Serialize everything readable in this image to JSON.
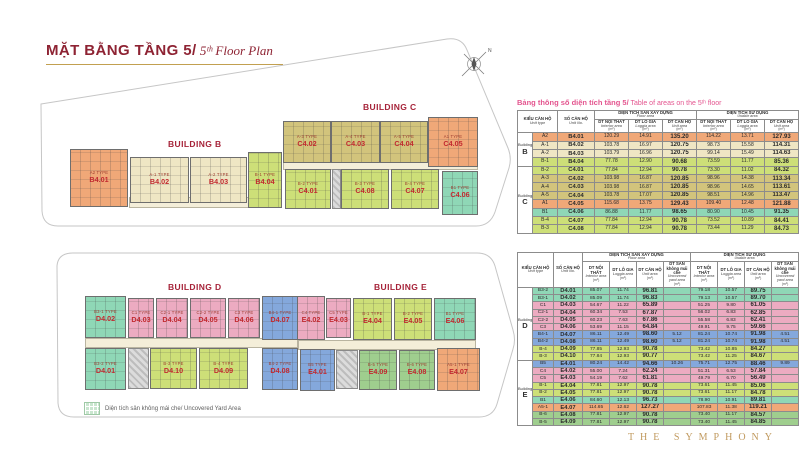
{
  "header": {
    "title_vi": "MẶT BẰNG TẦNG 5/",
    "title_en": " 5ᵗʰ Floor Plan"
  },
  "brand": "THE SYMPHONY",
  "compass": {
    "label": "N"
  },
  "legend": {
    "label": "Diện tích sân không mái che/ Uncovered Yard Area"
  },
  "colors": {
    "orange": "#f0a878",
    "cream": "#efe6c4",
    "olive": "#d2c47c",
    "yellowgreen": "#cddf78",
    "teal": "#8fd7b6",
    "pink": "#ecabc1",
    "blue": "#84a8dc",
    "green": "#9fce8e"
  },
  "plan": {
    "buildings": [
      {
        "id": "B",
        "label": "BUILDING B",
        "units": [
          {
            "no": "B4.01",
            "type": "A2 TYPE",
            "color": "orange"
          },
          {
            "no": "B4.02",
            "type": "A-1 TYPE",
            "color": "cream"
          },
          {
            "no": "B4.03",
            "type": "A-2 TYPE",
            "color": "cream"
          },
          {
            "no": "B4.04",
            "type": "B-1 TYPE",
            "color": "yellowgreen"
          }
        ]
      },
      {
        "id": "C",
        "label": "BUILDING C",
        "units": [
          {
            "no": "C4.02",
            "type": "A-3 TYPE",
            "color": "olive"
          },
          {
            "no": "C4.03",
            "type": "A-4 TYPE",
            "color": "olive"
          },
          {
            "no": "C4.04",
            "type": "A-5 TYPE",
            "color": "olive"
          },
          {
            "no": "C4.05",
            "type": "A1 TYPE",
            "color": "orange"
          },
          {
            "no": "C4.01",
            "type": "B-2 TYPE",
            "color": "yellowgreen"
          },
          {
            "no": "C4.08",
            "type": "B-3 TYPE",
            "color": "yellowgreen"
          },
          {
            "no": "C4.07",
            "type": "B-4 TYPE",
            "color": "yellowgreen"
          },
          {
            "no": "C4.06",
            "type": "B1 TYPE",
            "color": "teal"
          }
        ]
      },
      {
        "id": "D",
        "label": "BUILDING D",
        "units": [
          {
            "no": "D4.02",
            "type": "B3-1 TYPE",
            "color": "teal"
          },
          {
            "no": "D4.03",
            "type": "C1 TYPE",
            "color": "pink"
          },
          {
            "no": "D4.04",
            "type": "C2-1 TYPE",
            "color": "pink"
          },
          {
            "no": "D4.05",
            "type": "C2-2 TYPE",
            "color": "pink"
          },
          {
            "no": "D4.06",
            "type": "C3 TYPE",
            "color": "pink"
          },
          {
            "no": "D4.07",
            "type": "B4-1 TYPE",
            "color": "blue"
          },
          {
            "no": "D4.01",
            "type": "B3-2 TYPE",
            "color": "teal"
          },
          {
            "no": "D4.10",
            "type": "B-3 TYPE",
            "color": "yellowgreen"
          },
          {
            "no": "D4.09",
            "type": "B-4 TYPE",
            "color": "yellowgreen"
          },
          {
            "no": "D4.08",
            "type": "B4-2 TYPE",
            "color": "blue"
          }
        ]
      },
      {
        "id": "E",
        "label": "BUILDING E",
        "units": [
          {
            "no": "E4.02",
            "type": "C4 TYPE",
            "color": "pink"
          },
          {
            "no": "E4.03",
            "type": "C5 TYPE",
            "color": "pink"
          },
          {
            "no": "E4.04",
            "type": "B-1 TYPE",
            "color": "yellowgreen"
          },
          {
            "no": "E4.05",
            "type": "B-2 TYPE",
            "color": "yellowgreen"
          },
          {
            "no": "E4.06",
            "type": "B1 TYPE",
            "color": "teal"
          },
          {
            "no": "E4.01",
            "type": "B5 TYPE",
            "color": "blue"
          },
          {
            "no": "E4.09",
            "type": "B-5 TYPE",
            "color": "green"
          },
          {
            "no": "E4.08",
            "type": "B-6 TYPE",
            "color": "green"
          },
          {
            "no": "E4.07",
            "type": "A5-1 TYPE",
            "color": "orange"
          }
        ]
      }
    ]
  },
  "tables": {
    "caption_vi": "Bảng thông số diện tích tầng 5/",
    "caption_en": " Table of areas on the 5ᵗʰ floor",
    "headers": {
      "building_word": "Building",
      "unit_type_vi": "KIỂU CĂN HỘ",
      "unit_type_en": "Unit type",
      "unit_no_vi": "SỐ CĂN HỘ",
      "unit_no_en": "Unit No.",
      "floor_vi": "DIỆN TÍCH SÀN XÂY DỰNG",
      "floor_en": "Floor area",
      "use_vi": "DIỆN TÍCH SỬ DỤNG",
      "use_en": "Usable area",
      "interior_vi": "DT NỘI THẤT",
      "interior_en": "Interior area",
      "loggia_vi": "DT LÔ GIA",
      "loggia_en": "Loggia area",
      "unit_vi": "DT CĂN HỘ",
      "unit_en": "Unit area",
      "yard_vi": "DT SÂN không mái che",
      "yard_en": "Uncovered yard area",
      "sqm": "(m²)"
    },
    "table_bc": {
      "groups": [
        {
          "building": "B",
          "rows": [
            {
              "type": "A2",
              "no": "B4.01",
              "color": "orange",
              "v": [
                "120.29",
                "14.91",
                "135.20",
                "114.22",
                "13.71",
                "127.93"
              ]
            },
            {
              "type": "A-1",
              "no": "B4.02",
              "color": "cream",
              "v": [
                "103.78",
                "16.97",
                "120.75",
                "98.73",
                "15.58",
                "114.31"
              ]
            },
            {
              "type": "A-2",
              "no": "B4.03",
              "color": "cream",
              "v": [
                "103.79",
                "16.96",
                "120.75",
                "99.14",
                "15.49",
                "114.63"
              ]
            },
            {
              "type": "B-1",
              "no": "B4.04",
              "color": "yellowgreen",
              "v": [
                "77.78",
                "12.90",
                "90.68",
                "73.59",
                "11.77",
                "85.36"
              ]
            }
          ]
        },
        {
          "building": "C",
          "rows": [
            {
              "type": "B-2",
              "no": "C4.01",
              "color": "yellowgreen",
              "v": [
                "77.84",
                "12.94",
                "90.78",
                "73.30",
                "11.02",
                "84.32"
              ]
            },
            {
              "type": "A-3",
              "no": "C4.02",
              "color": "olive",
              "v": [
                "103.98",
                "16.87",
                "120.85",
                "98.96",
                "14.38",
                "113.34"
              ]
            },
            {
              "type": "A-4",
              "no": "C4.03",
              "color": "olive",
              "v": [
                "103.98",
                "16.87",
                "120.85",
                "98.96",
                "14.65",
                "113.61"
              ]
            },
            {
              "type": "A-5",
              "no": "C4.04",
              "color": "olive",
              "v": [
                "103.78",
                "17.07",
                "120.85",
                "98.51",
                "14.96",
                "113.47"
              ]
            },
            {
              "type": "A1",
              "no": "C4.05",
              "color": "orange",
              "v": [
                "115.68",
                "13.75",
                "129.43",
                "109.40",
                "12.48",
                "121.88"
              ]
            },
            {
              "type": "B1",
              "no": "C4.06",
              "color": "teal",
              "v": [
                "86.88",
                "11.77",
                "98.65",
                "80.90",
                "10.45",
                "91.35"
              ]
            },
            {
              "type": "B-4",
              "no": "C4.07",
              "color": "yellowgreen",
              "v": [
                "77.84",
                "12.94",
                "90.78",
                "73.52",
                "10.89",
                "84.41"
              ]
            },
            {
              "type": "B-3",
              "no": "C4.08",
              "color": "yellowgreen",
              "v": [
                "77.84",
                "12.94",
                "90.78",
                "73.44",
                "11.29",
                "84.73"
              ]
            }
          ]
        }
      ]
    },
    "table_de": {
      "groups": [
        {
          "building": "D",
          "rows": [
            {
              "type": "B3-2",
              "no": "D4.01",
              "color": "teal",
              "v": [
                "85.07",
                "11.74",
                "96.81",
                "",
                "79.18",
                "10.57",
                "89.75",
                ""
              ]
            },
            {
              "type": "B3-1",
              "no": "D4.02",
              "color": "teal",
              "v": [
                "85.09",
                "11.74",
                "96.83",
                "",
                "79.13",
                "10.57",
                "89.70",
                ""
              ]
            },
            {
              "type": "C1",
              "no": "D4.03",
              "color": "pink",
              "v": [
                "54.67",
                "11.22",
                "65.89",
                "",
                "51.25",
                "9.80",
                "61.05",
                ""
              ]
            },
            {
              "type": "C2-1",
              "no": "D4.04",
              "color": "pink",
              "v": [
                "60.34",
                "7.53",
                "67.87",
                "",
                "56.02",
                "6.83",
                "62.85",
                ""
              ]
            },
            {
              "type": "C2-2",
              "no": "D4.05",
              "color": "pink",
              "v": [
                "60.23",
                "7.63",
                "67.86",
                "",
                "55.58",
                "6.83",
                "62.41",
                ""
              ]
            },
            {
              "type": "C3",
              "no": "D4.06",
              "color": "pink",
              "v": [
                "53.69",
                "11.15",
                "64.84",
                "",
                "49.91",
                "9.75",
                "59.66",
                ""
              ]
            },
            {
              "type": "B4-1",
              "no": "D4.07",
              "color": "blue",
              "v": [
                "86.11",
                "12.49",
                "98.60",
                "5.12",
                "81.24",
                "10.74",
                "91.98",
                "4.51"
              ]
            },
            {
              "type": "B4-2",
              "no": "D4.08",
              "color": "blue",
              "v": [
                "86.11",
                "12.49",
                "98.60",
                "5.12",
                "81.24",
                "10.74",
                "91.98",
                "4.51"
              ]
            },
            {
              "type": "B-4",
              "no": "D4.09",
              "color": "yellowgreen",
              "v": [
                "77.85",
                "12.93",
                "90.78",
                "",
                "73.42",
                "10.85",
                "84.27",
                ""
              ]
            },
            {
              "type": "B-3",
              "no": "D4.10",
              "color": "yellowgreen",
              "v": [
                "77.84",
                "12.93",
                "90.77",
                "",
                "73.42",
                "11.25",
                "84.67",
                ""
              ]
            }
          ]
        },
        {
          "building": "E",
          "rows": [
            {
              "type": "B5",
              "no": "E4.01",
              "color": "blue",
              "v": [
                "80.24",
                "14.42",
                "94.66",
                "10.26",
                "75.71",
                "12.75",
                "88.46",
                "9.89"
              ]
            },
            {
              "type": "C4",
              "no": "E4.02",
              "color": "pink",
              "v": [
                "55.00",
                "7.24",
                "62.24",
                "",
                "51.31",
                "6.53",
                "57.84",
                ""
              ]
            },
            {
              "type": "C5",
              "no": "E4.03",
              "color": "pink",
              "v": [
                "54.19",
                "7.62",
                "61.81",
                "",
                "49.79",
                "6.70",
                "56.49",
                ""
              ]
            },
            {
              "type": "B-1",
              "no": "E4.04",
              "color": "yellowgreen",
              "v": [
                "77.81",
                "12.97",
                "90.78",
                "",
                "73.61",
                "11.45",
                "85.06",
                ""
              ]
            },
            {
              "type": "B-2",
              "no": "E4.05",
              "color": "yellowgreen",
              "v": [
                "77.81",
                "12.97",
                "90.78",
                "",
                "73.61",
                "11.17",
                "84.78",
                ""
              ]
            },
            {
              "type": "B1",
              "no": "E4.06",
              "color": "teal",
              "v": [
                "84.60",
                "12.13",
                "96.73",
                "",
                "78.90",
                "10.91",
                "89.81",
                ""
              ]
            },
            {
              "type": "A5-1",
              "no": "E4.07",
              "color": "orange",
              "v": [
                "114.65",
                "12.62",
                "127.27",
                "",
                "107.83",
                "11.38",
                "119.21",
                ""
              ]
            },
            {
              "type": "B-6",
              "no": "E4.08",
              "color": "green",
              "v": [
                "77.81",
                "12.97",
                "90.78",
                "",
                "73.40",
                "11.17",
                "84.57",
                ""
              ]
            },
            {
              "type": "B-5",
              "no": "E4.09",
              "color": "green",
              "v": [
                "77.81",
                "12.97",
                "90.78",
                "",
                "73.40",
                "11.45",
                "84.85",
                ""
              ]
            }
          ]
        }
      ]
    }
  }
}
